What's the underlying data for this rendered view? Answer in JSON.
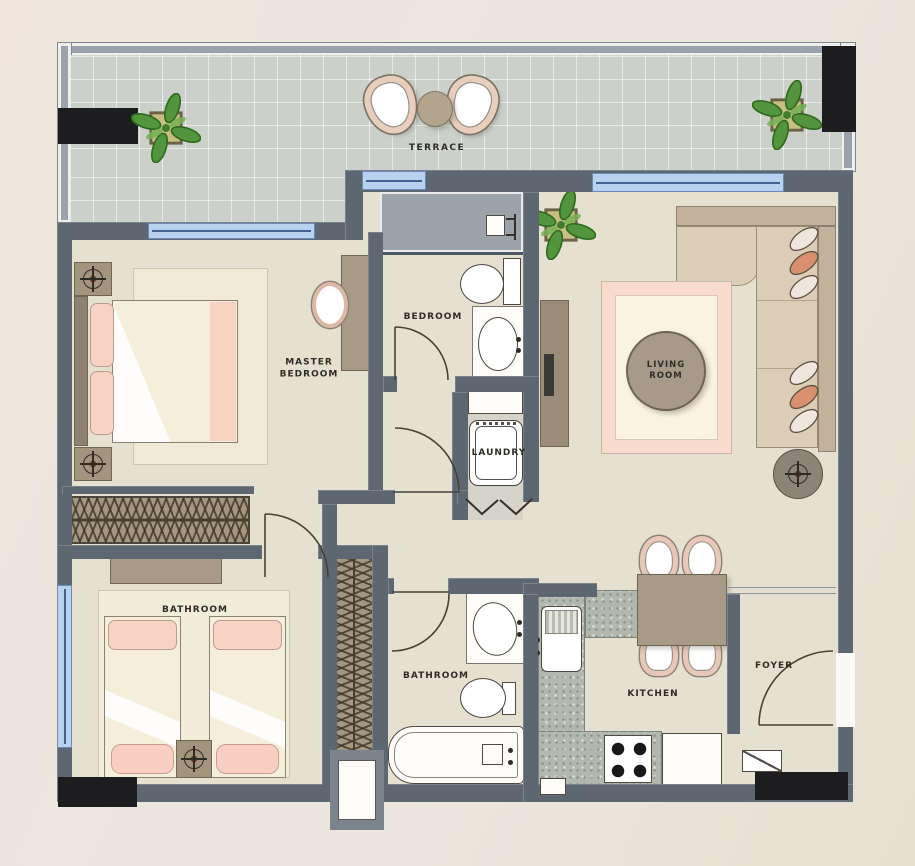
{
  "meta": {
    "type": "apartment-floor-plan"
  },
  "rooms": [
    {
      "id": "terrace",
      "label": "TERRACE"
    },
    {
      "id": "master-bedroom",
      "label": "MASTER BEDROOM"
    },
    {
      "id": "bedroom",
      "label": "BEDROOM"
    },
    {
      "id": "living-room",
      "label": "LIVING ROOM"
    },
    {
      "id": "laundry",
      "label": "LAUNDRY"
    },
    {
      "id": "second-bedroom",
      "label": "BATHROOM"
    },
    {
      "id": "bathroom",
      "label": "BATHROOM"
    },
    {
      "id": "kitchen",
      "label": "KITCHEN"
    },
    {
      "id": "foyer",
      "label": "FOYER"
    }
  ],
  "fixtures": [
    "double-bed",
    "twin-beds",
    "wardrobe",
    "washing-machine",
    "toilet",
    "washbasin",
    "bathtub",
    "shower",
    "kitchen-sink",
    "stove",
    "fridge",
    "dining-table",
    "sofa",
    "coffee-table",
    "tv-unit",
    "floor-lamp",
    "plant",
    "terrace-chairs",
    "terrace-table"
  ],
  "palette": {
    "background": "#ece7de",
    "wall": "#5d6772",
    "floor": "#e6e0d0",
    "terrace_tile": "#cbd1ca",
    "window_glass": "#b7d1ef",
    "wood": "#a3947e",
    "granite": "#b2b8ae",
    "accent_pink": "#f7d0c0",
    "column_black": "#1d1d1f",
    "label_text": "#2f2d27"
  }
}
